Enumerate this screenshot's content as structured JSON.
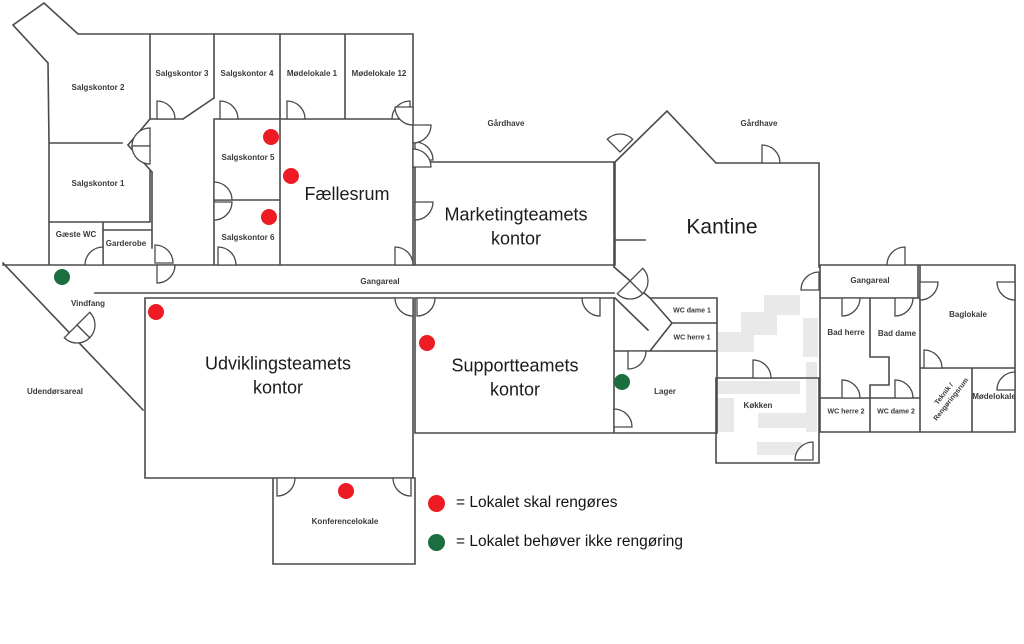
{
  "colors": {
    "wall": "#4a4a4a",
    "needs_cleaning_dot": "#ed1c24",
    "no_cleaning_dot": "#1b6e3d",
    "furniture_gray": "#e9e9e9",
    "text": "#1c1c1c"
  },
  "rooms": [
    {
      "id": "salgskontor-2",
      "label": "Salgskontor 2",
      "x": 98,
      "y": 88,
      "size": "s"
    },
    {
      "id": "salgskontor-3",
      "label": "Salgskontor 3",
      "x": 182,
      "y": 74,
      "size": "s"
    },
    {
      "id": "salgskontor-4",
      "label": "Salgskontor 4",
      "x": 247,
      "y": 74,
      "size": "s"
    },
    {
      "id": "modelokale-1",
      "label": "Mødelokale 1",
      "x": 312,
      "y": 74,
      "size": "s"
    },
    {
      "id": "modelokale-12",
      "label": "Mødelokale 12",
      "x": 379,
      "y": 74,
      "size": "s"
    },
    {
      "id": "salgskontor-1",
      "label": "Salgskontor 1",
      "x": 98,
      "y": 184,
      "size": "s"
    },
    {
      "id": "salgskontor-5",
      "label": "Salgskontor 5",
      "x": 248,
      "y": 158,
      "size": "s"
    },
    {
      "id": "salgskontor-6",
      "label": "Salgskontor 6",
      "x": 248,
      "y": 238,
      "size": "s"
    },
    {
      "id": "faellesrum",
      "label": "Fællesrum",
      "x": 347,
      "y": 194,
      "size": "l"
    },
    {
      "id": "gaeste-wc",
      "label": "Gæste WC",
      "x": 76,
      "y": 235,
      "size": "xs"
    },
    {
      "id": "garderobe",
      "label": "Garderobe",
      "x": 126,
      "y": 244,
      "size": "xs"
    },
    {
      "id": "gardhave-vest",
      "label": "Gårdhave",
      "x": 506,
      "y": 124,
      "size": "xs"
    },
    {
      "id": "gardhave-ost",
      "label": "Gårdhave",
      "x": 759,
      "y": 124,
      "size": "xs"
    },
    {
      "id": "marketingteamets-kontor",
      "label": "Marketingteamets\nkontor",
      "x": 516,
      "y": 227,
      "size": "l"
    },
    {
      "id": "kantine",
      "label": "Kantine",
      "x": 722,
      "y": 227,
      "size": "xl"
    },
    {
      "id": "gangareal",
      "label": "Gangareal",
      "x": 380,
      "y": 282,
      "size": "xs"
    },
    {
      "id": "wc-dame-1",
      "label": "WC dame 1",
      "x": 692,
      "y": 311,
      "size": "xxs"
    },
    {
      "id": "wc-herre-1",
      "label": "WC herre 1",
      "x": 692,
      "y": 338,
      "size": "xxs"
    },
    {
      "id": "vindfang",
      "label": "Vindfang",
      "x": 88,
      "y": 304,
      "size": "xs"
    },
    {
      "id": "udendorsareal",
      "label": "Udendørsareal",
      "x": 55,
      "y": 392,
      "size": "xs"
    },
    {
      "id": "udviklingsteamets-kontor",
      "label": "Udviklingsteamets\nkontor",
      "x": 278,
      "y": 376,
      "size": "l"
    },
    {
      "id": "supportteamets-kontor",
      "label": "Supportteamets\nkontor",
      "x": 515,
      "y": 378,
      "size": "l"
    },
    {
      "id": "lager",
      "label": "Lager",
      "x": 665,
      "y": 392,
      "size": "xs"
    },
    {
      "id": "kokken",
      "label": "Køkken",
      "x": 758,
      "y": 406,
      "size": "xs"
    },
    {
      "id": "gangareal-2",
      "label": "Gangareal",
      "x": 870,
      "y": 281,
      "size": "xs"
    },
    {
      "id": "bad-herre",
      "label": "Bad herre",
      "x": 846,
      "y": 333,
      "size": "xs"
    },
    {
      "id": "bad-dame",
      "label": "Bad dame",
      "x": 897,
      "y": 334,
      "size": "xs"
    },
    {
      "id": "baglokale",
      "label": "Baglokale",
      "x": 968,
      "y": 315,
      "size": "xs"
    },
    {
      "id": "wc-herre-2",
      "label": "WC herre 2",
      "x": 846,
      "y": 412,
      "size": "xxs"
    },
    {
      "id": "wc-dame-2",
      "label": "WC dame 2",
      "x": 896,
      "y": 412,
      "size": "xxs"
    },
    {
      "id": "teknik-rengoringsrum",
      "label": "Teknik /\nRengøringsrum",
      "x": 948,
      "y": 397,
      "size": "xxs",
      "rotate": -52
    },
    {
      "id": "modelokale",
      "label": "Mødelokale",
      "x": 994,
      "y": 397,
      "size": "xs"
    },
    {
      "id": "konferencelokale",
      "label": "Konferencelokale",
      "x": 345,
      "y": 522,
      "size": "xs"
    }
  ],
  "status_dots": [
    {
      "room": "Salgskontor 5",
      "x": 271,
      "y": 137,
      "status": "needs-cleaning",
      "color": "#ed1c24"
    },
    {
      "room": "Fællesrum",
      "x": 291,
      "y": 176,
      "status": "needs-cleaning",
      "color": "#ed1c24"
    },
    {
      "room": "Salgskontor 6",
      "x": 269,
      "y": 217,
      "status": "needs-cleaning",
      "color": "#ed1c24"
    },
    {
      "room": "Udviklingsteamets kontor",
      "x": 156,
      "y": 312,
      "status": "needs-cleaning",
      "color": "#ed1c24"
    },
    {
      "room": "Supportteamets kontor",
      "x": 427,
      "y": 343,
      "status": "needs-cleaning",
      "color": "#ed1c24"
    },
    {
      "room": "Konferencelokale",
      "x": 346,
      "y": 491,
      "status": "needs-cleaning",
      "color": "#ed1c24"
    },
    {
      "room": "Vindfang",
      "x": 62,
      "y": 277,
      "status": "no-cleaning-needed",
      "color": "#1b6e3d"
    },
    {
      "room": "Lager",
      "x": 622,
      "y": 382,
      "status": "no-cleaning-needed",
      "color": "#1b6e3d"
    }
  ],
  "legend": {
    "items": [
      {
        "icon": "red-dot-icon",
        "color": "#ed1c24",
        "label": "= Lokalet skal rengøres"
      },
      {
        "icon": "green-dot-icon",
        "color": "#1b6e3d",
        "label": "= Lokalet behøver ikke rengøring"
      }
    ]
  }
}
